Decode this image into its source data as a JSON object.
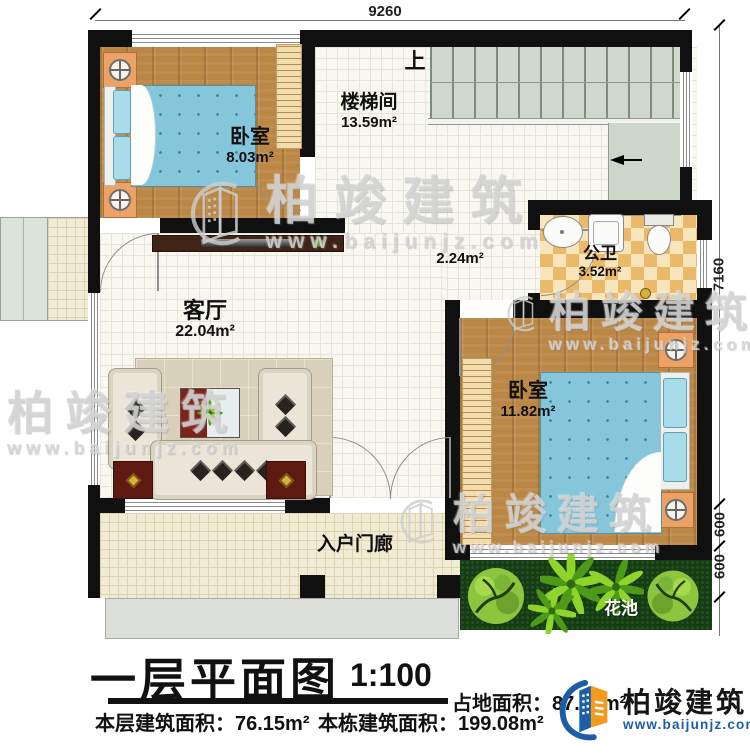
{
  "plan": {
    "dimensions": {
      "top": "9260",
      "right_total": "7160",
      "right_seg_a": "600",
      "right_seg_b": "600"
    },
    "stairs": {
      "up_label": "上"
    },
    "hallway": {
      "area": "2.24m²"
    },
    "rooms": {
      "bedroom_top": {
        "label": "卧室",
        "area": "8.03m²"
      },
      "stairwell": {
        "label": "楼梯间",
        "area": "13.59m²"
      },
      "bathroom": {
        "label": "公卫",
        "area": "3.52m²"
      },
      "living_room": {
        "label": "客厅",
        "area": "22.04m²"
      },
      "bedroom_right": {
        "label": "卧室",
        "area": "11.82m²"
      },
      "entry_porch": {
        "label": "入户门廊"
      },
      "flower_bed": {
        "label": "花池"
      }
    }
  },
  "title_block": {
    "title": "一层平面图",
    "scale": "1:100",
    "site_area_label": "占地面积：",
    "site_area_value": "87.",
    "site_area_unit": "m²",
    "floor_area_text": "本层建筑面积：76.15m²",
    "building_area_text": "本栋建筑面积：199.08m²"
  },
  "branding": {
    "name": "柏竣建筑",
    "url": "www.baijunjz.com"
  },
  "colors": {
    "wall": "#101010",
    "brand_blue": "#1b5ea6",
    "brand_orange": "#f29b1d",
    "bed_blue": "#85c6da",
    "wood": "#bb8746",
    "grass": "#143d12",
    "checker_tan": "#eab969"
  }
}
